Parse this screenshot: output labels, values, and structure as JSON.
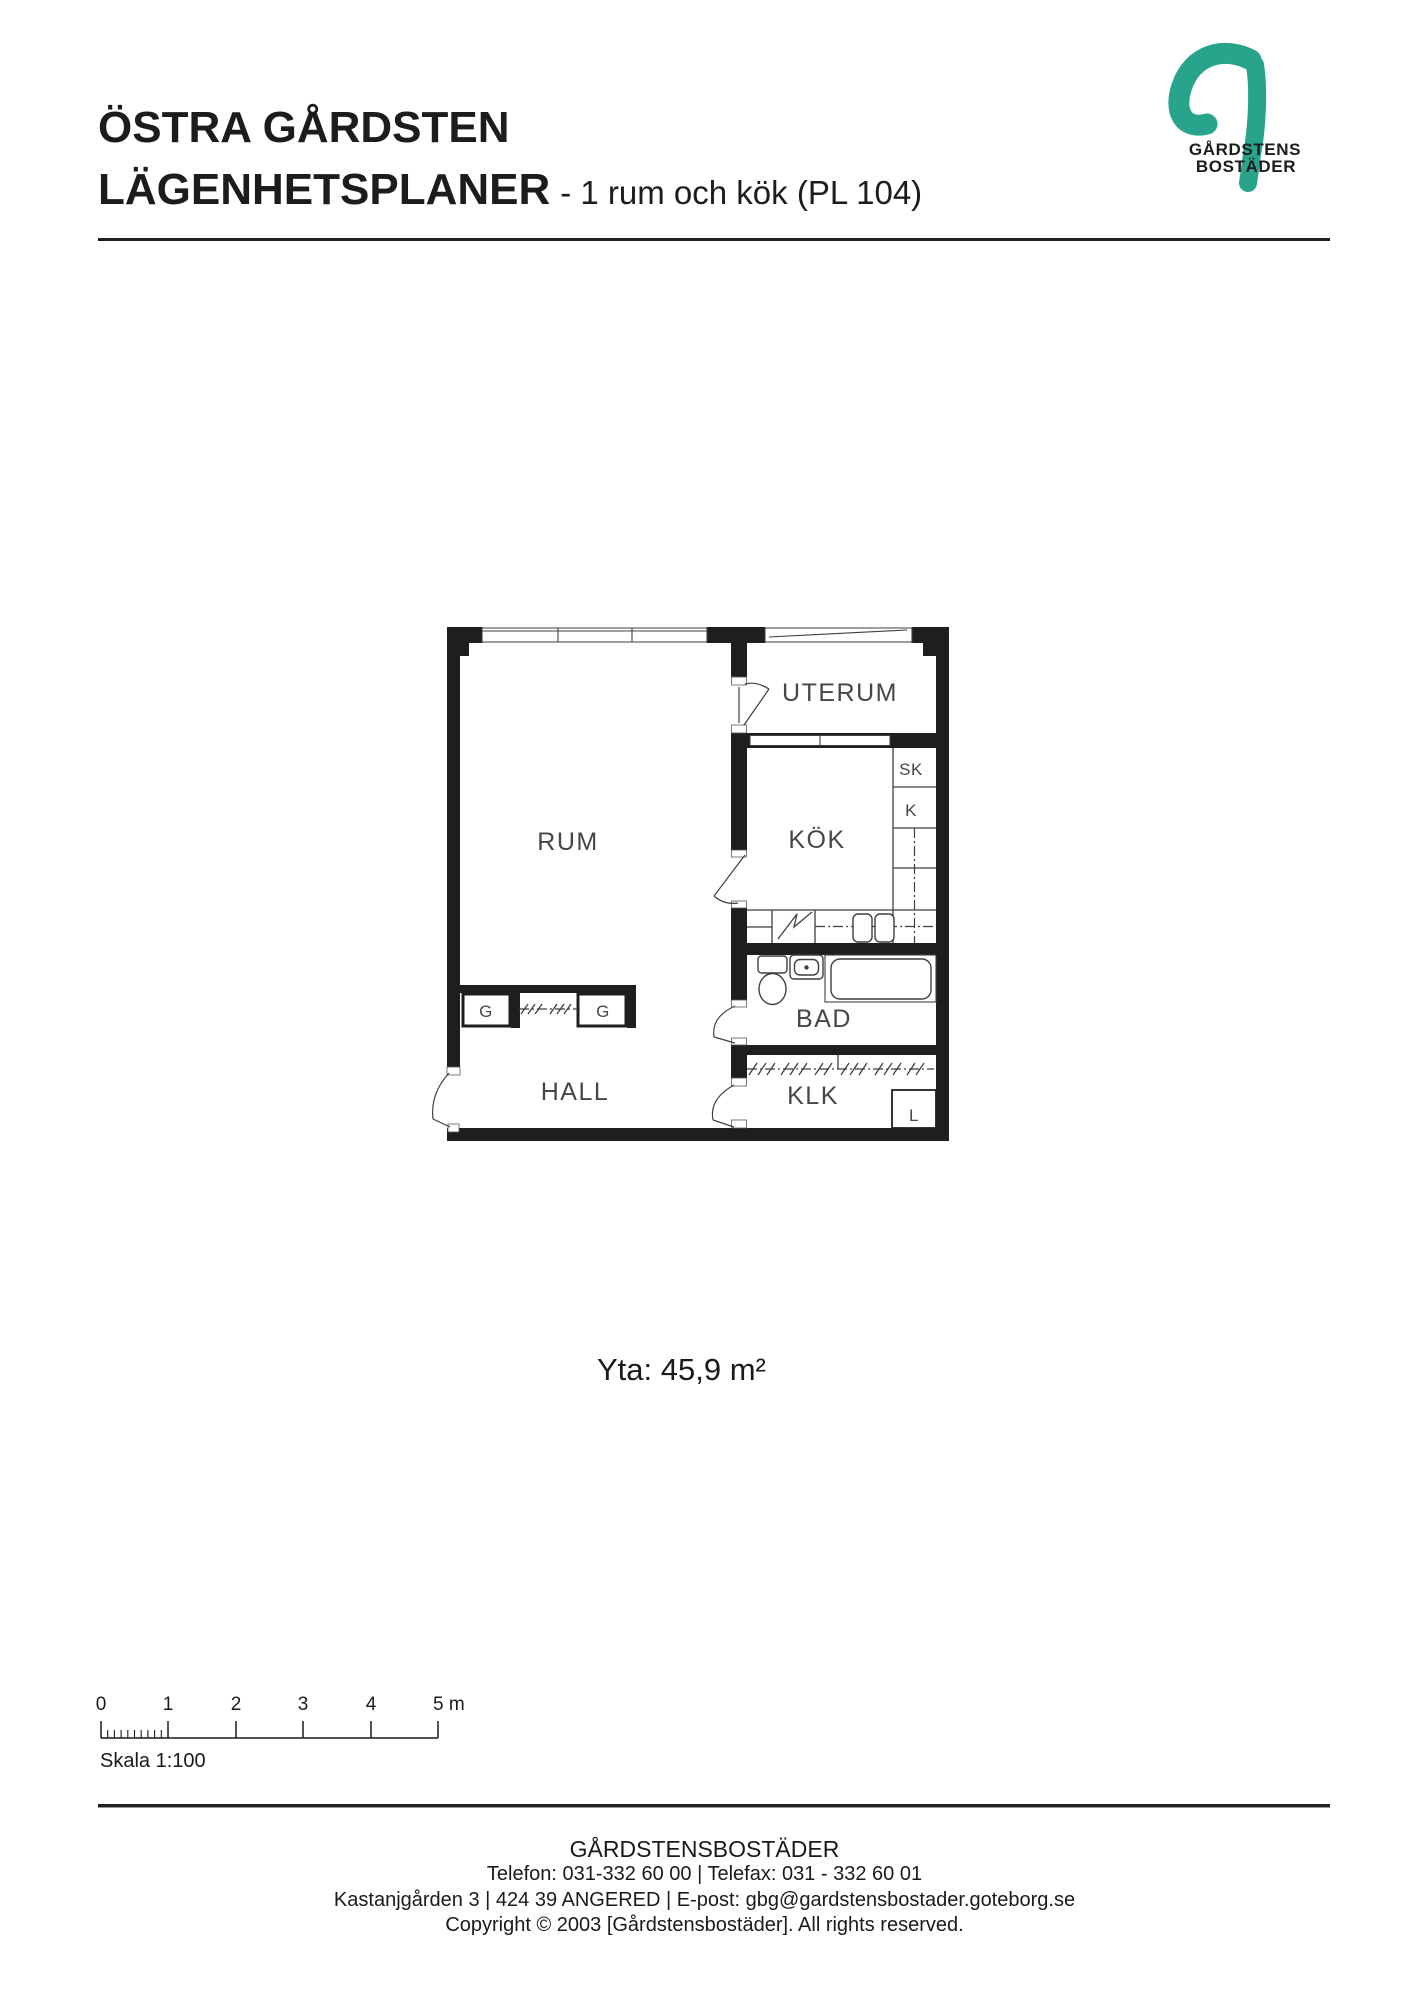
{
  "header": {
    "title_line1": "ÖSTRA GÅRDSTEN",
    "title_line2": "LÄGENHETSPLANER",
    "subtitle": "- 1 rum och kök (PL 104)"
  },
  "logo": {
    "brand_color": "#28a38c",
    "name_line1": "GÅRDSTENS",
    "name_line2": "BOSTÄDER"
  },
  "floorplan": {
    "labels": {
      "uterum": "UTERUM",
      "rum": "RUM",
      "kok": "KÖK",
      "sk": "SK",
      "k": "K",
      "g1": "G",
      "g2": "G",
      "bad": "BAD",
      "hall": "HALL",
      "klk": "KLK",
      "l": "L"
    }
  },
  "area_text": "Yta: 45,9 m²",
  "scalebar": {
    "labels": [
      "0",
      "1",
      "2",
      "3",
      "4",
      "5 m"
    ],
    "caption": "Skala 1:100"
  },
  "footer": {
    "company": "GÅRDSTENSBOSTÄDER",
    "contact": "Telefon: 031-332 60 00 | Telefax: 031 - 332 60 01",
    "address": "Kastanjgården 3 | 424 39 ANGERED | E-post: gbg@gardstensbostader.goteborg.se",
    "copyright": "Copyright © 2003 [Gårdstensbostäder]. All rights reserved."
  }
}
